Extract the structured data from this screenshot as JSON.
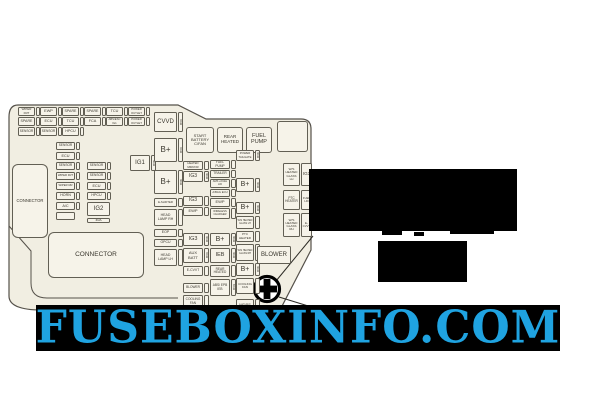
{
  "page": {
    "background": "#ffffff"
  },
  "watermark": {
    "text": "FUSEBOXINFO.COM",
    "text_color": "#1fa3e1",
    "band_color": "#000000",
    "band": {
      "x": 36,
      "y": 305,
      "w": 524,
      "h": 46
    }
  },
  "icons": {
    "marker": "plus-circle"
  },
  "diagram": {
    "panel_fill": "#f1eee2",
    "line_color": "#55514a",
    "box_fill": "#f6f3e9",
    "text_color": "#3a372e",
    "connectors": [
      {
        "x": 12,
        "y": 164,
        "w": 36,
        "h": 74,
        "label": "CONNECTOR",
        "fs": 4.2
      },
      {
        "x": 48,
        "y": 232,
        "w": 96,
        "h": 46,
        "label": "CONNECTOR",
        "fs": 6.5
      }
    ],
    "blocks": [
      {
        "x": 186,
        "y": 127,
        "w": 28,
        "h": 26,
        "label": "START\nBATTERY\nC/FAN",
        "fs": 4
      },
      {
        "x": 217,
        "y": 127,
        "w": 26,
        "h": 26,
        "label": "REAR\nHEATED",
        "fs": 4.5
      },
      {
        "x": 246,
        "y": 127,
        "w": 26,
        "h": 26,
        "label": "FUEL\nPUMP",
        "fs": 5.5
      },
      {
        "x": 277,
        "y": 121,
        "w": 31,
        "h": 31,
        "label": "",
        "fs": 4
      }
    ],
    "fuses": [
      {
        "x": 18,
        "y": 107,
        "w": 17,
        "h": 9,
        "label": "WIPER FRT",
        "fs": 3,
        "strip": "sq",
        "amp": ""
      },
      {
        "x": 40,
        "y": 107,
        "w": 17,
        "h": 9,
        "label": "EWP",
        "fs": 3.8,
        "strip": "sq",
        "amp": ""
      },
      {
        "x": 62,
        "y": 107,
        "w": 17,
        "h": 9,
        "label": "SPARE",
        "fs": 3.6,
        "strip": "sq",
        "amp": ""
      },
      {
        "x": 84,
        "y": 107,
        "w": 17,
        "h": 9,
        "label": "SPARE",
        "fs": 3.6,
        "strip": "sq",
        "amp": ""
      },
      {
        "x": 106,
        "y": 107,
        "w": 17,
        "h": 9,
        "label": "TCU",
        "fs": 3.8,
        "strip": "sq",
        "amp": ""
      },
      {
        "x": 128,
        "y": 107,
        "w": 17,
        "h": 9,
        "label": "POWER OUTLET",
        "fs": 2.8,
        "strip": "sq",
        "amp": ""
      },
      {
        "x": 18,
        "y": 117,
        "w": 17,
        "h": 9,
        "label": "SPARE",
        "fs": 3.6,
        "strip": "sq",
        "amp": ""
      },
      {
        "x": 40,
        "y": 117,
        "w": 17,
        "h": 9,
        "label": "ECU",
        "fs": 3.8,
        "strip": "sq",
        "amp": ""
      },
      {
        "x": 62,
        "y": 117,
        "w": 17,
        "h": 9,
        "label": "TCU",
        "fs": 3.8,
        "strip": "sq",
        "amp": ""
      },
      {
        "x": 84,
        "y": 117,
        "w": 17,
        "h": 9,
        "label": "FCA",
        "fs": 3.8,
        "strip": "sq",
        "amp": ""
      },
      {
        "x": 106,
        "y": 117,
        "w": 17,
        "h": 9,
        "label": "ABS/ESC IG1",
        "fs": 2.8,
        "strip": "sq",
        "amp": ""
      },
      {
        "x": 128,
        "y": 117,
        "w": 17,
        "h": 9,
        "label": "POWER OUTLET",
        "fs": 2.8,
        "strip": "sq",
        "amp": ""
      },
      {
        "x": 18,
        "y": 127,
        "w": 17,
        "h": 9,
        "label": "SENSOR",
        "fs": 3.2,
        "strip": "sq",
        "amp": ""
      },
      {
        "x": 40,
        "y": 127,
        "w": 17,
        "h": 9,
        "label": "SENSOR",
        "fs": 3.2,
        "strip": "sq",
        "amp": ""
      },
      {
        "x": 62,
        "y": 127,
        "w": 17,
        "h": 9,
        "label": "HPCU",
        "fs": 3.6,
        "strip": "sq",
        "amp": ""
      },
      {
        "x": 56,
        "y": 142,
        "w": 19,
        "h": 8,
        "label": "SENSOR",
        "fs": 3.2,
        "strip": "sq",
        "amp": ""
      },
      {
        "x": 56,
        "y": 152,
        "w": 19,
        "h": 8,
        "label": "ECU",
        "fs": 3.8,
        "strip": "sq",
        "amp": ""
      },
      {
        "x": 56,
        "y": 162,
        "w": 19,
        "h": 8,
        "label": "SENSOR",
        "fs": 3.2,
        "strip": "sq",
        "amp": ""
      },
      {
        "x": 56,
        "y": 172,
        "w": 19,
        "h": 8,
        "label": "WIPER FRT",
        "fs": 2.8,
        "strip": "sq",
        "amp": ""
      },
      {
        "x": 56,
        "y": 182,
        "w": 19,
        "h": 8,
        "label": "WIPER RR",
        "fs": 2.8,
        "strip": "sq",
        "amp": ""
      },
      {
        "x": 56,
        "y": 192,
        "w": 19,
        "h": 8,
        "label": "HORN",
        "fs": 3.6,
        "strip": "sq",
        "amp": ""
      },
      {
        "x": 56,
        "y": 202,
        "w": 19,
        "h": 8,
        "label": "A/C",
        "fs": 3.8,
        "strip": "sq",
        "amp": ""
      },
      {
        "x": 56,
        "y": 212,
        "w": 19,
        "h": 8,
        "label": "",
        "fs": 3.8,
        "strip": null,
        "amp": ""
      },
      {
        "x": 87,
        "y": 162,
        "w": 19,
        "h": 8,
        "label": "SENSOR",
        "fs": 3.2,
        "strip": "sq",
        "amp": ""
      },
      {
        "x": 87,
        "y": 172,
        "w": 19,
        "h": 8,
        "label": "SENSOR",
        "fs": 3.2,
        "strip": "sq",
        "amp": ""
      },
      {
        "x": 87,
        "y": 182,
        "w": 19,
        "h": 8,
        "label": "ECU",
        "fs": 3.8,
        "strip": "sq",
        "amp": ""
      },
      {
        "x": 87,
        "y": 192,
        "w": 19,
        "h": 8,
        "label": "HPCU",
        "fs": 3.6,
        "strip": "sq",
        "amp": ""
      },
      {
        "x": 87,
        "y": 202,
        "w": 23,
        "h": 14,
        "label": "IG2",
        "fs": 6,
        "strip": null,
        "amp": ""
      },
      {
        "x": 87,
        "y": 218,
        "w": 23,
        "h": 5,
        "label": "40A",
        "fs": 3.4,
        "strip": null,
        "amp": ""
      },
      {
        "x": 130,
        "y": 155,
        "w": 20,
        "h": 16,
        "label": "IG1",
        "fs": 6,
        "strip": "v",
        "amp": "40A"
      },
      {
        "x": 154,
        "y": 112,
        "w": 23,
        "h": 20,
        "label": "CVVD",
        "fs": 6,
        "strip": "v",
        "amp": "50A"
      },
      {
        "x": 154,
        "y": 138,
        "w": 23,
        "h": 24,
        "label": "B+",
        "fs": 8,
        "strip": "v",
        "amp": "50A"
      },
      {
        "x": 154,
        "y": 170,
        "w": 23,
        "h": 24,
        "label": "B+",
        "fs": 8,
        "strip": "v",
        "amp": "40A"
      },
      {
        "x": 154,
        "y": 198,
        "w": 23,
        "h": 9,
        "label": "E-SHIFTER",
        "fs": 2.8,
        "strip": "v",
        "amp": ""
      },
      {
        "x": 154,
        "y": 209,
        "w": 23,
        "h": 17,
        "label": "HEAD LAMP RH",
        "fs": 3.5,
        "strip": "v",
        "amp": ""
      },
      {
        "x": 154,
        "y": 229,
        "w": 23,
        "h": 8,
        "label": "EOP",
        "fs": 3.5,
        "strip": "v",
        "amp": ""
      },
      {
        "x": 154,
        "y": 239,
        "w": 23,
        "h": 8,
        "label": "OPCU",
        "fs": 3.5,
        "strip": "v",
        "amp": ""
      },
      {
        "x": 154,
        "y": 249,
        "w": 23,
        "h": 17,
        "label": "HEAD LAMP LH",
        "fs": 3.5,
        "strip": "v",
        "amp": ""
      },
      {
        "x": 183,
        "y": 161,
        "w": 20,
        "h": 9,
        "label": "HEATED MIRROR",
        "fs": 2.8,
        "strip": "v",
        "amp": ""
      },
      {
        "x": 183,
        "y": 171,
        "w": 20,
        "h": 11,
        "label": "IG3",
        "fs": 5,
        "strip": "v",
        "amp": "40A"
      },
      {
        "x": 183,
        "y": 196,
        "w": 20,
        "h": 10,
        "label": "IG3",
        "fs": 5,
        "strip": "v",
        "amp": ""
      },
      {
        "x": 183,
        "y": 207,
        "w": 20,
        "h": 9,
        "label": "EWP",
        "fs": 4,
        "strip": "v",
        "amp": ""
      },
      {
        "x": 183,
        "y": 233,
        "w": 20,
        "h": 13,
        "label": "IG3",
        "fs": 5.5,
        "strip": "v",
        "amp": "40A"
      },
      {
        "x": 183,
        "y": 248,
        "w": 20,
        "h": 15,
        "label": "AUX BATT",
        "fs": 4,
        "strip": "v",
        "amp": "50A"
      },
      {
        "x": 183,
        "y": 266,
        "w": 20,
        "h": 10,
        "label": "E-CVVT",
        "fs": 3.4,
        "strip": "v",
        "amp": ""
      },
      {
        "x": 183,
        "y": 283,
        "w": 20,
        "h": 10,
        "label": "BLOWER",
        "fs": 3.2,
        "strip": "v",
        "amp": ""
      },
      {
        "x": 183,
        "y": 295,
        "w": 20,
        "h": 13,
        "label": "COOLING FAN",
        "fs": 3.2,
        "strip": "v",
        "amp": ""
      },
      {
        "x": 210,
        "y": 160,
        "w": 20,
        "h": 9,
        "label": "FUEL PUMP",
        "fs": 3.2,
        "strip": "v",
        "amp": ""
      },
      {
        "x": 210,
        "y": 170,
        "w": 20,
        "h": 8,
        "label": "TRAILER",
        "fs": 3.2,
        "strip": "v",
        "amp": ""
      },
      {
        "x": 210,
        "y": 179,
        "w": 20,
        "h": 9,
        "label": "AMS +FUEL LID",
        "fs": 2.6,
        "strip": "v",
        "amp": ""
      },
      {
        "x": 210,
        "y": 189,
        "w": 20,
        "h": 8,
        "label": "A/BAG ECU",
        "fs": 2.8,
        "strip": "v",
        "amp": ""
      },
      {
        "x": 210,
        "y": 198,
        "w": 20,
        "h": 9,
        "label": "EWP",
        "fs": 4,
        "strip": "v",
        "amp": ""
      },
      {
        "x": 210,
        "y": 208,
        "w": 20,
        "h": 11,
        "label": "WIRELESS CHARGER",
        "fs": 2.6,
        "strip": "v",
        "amp": ""
      },
      {
        "x": 210,
        "y": 233,
        "w": 20,
        "h": 13,
        "label": "B+",
        "fs": 7,
        "strip": "v",
        "amp": "40A"
      },
      {
        "x": 210,
        "y": 248,
        "w": 20,
        "h": 15,
        "label": "IEB",
        "fs": 5.5,
        "strip": "v",
        "amp": "40A"
      },
      {
        "x": 210,
        "y": 265,
        "w": 20,
        "h": 12,
        "label": "REAR HEATED",
        "fs": 3.2,
        "strip": "v",
        "amp": ""
      },
      {
        "x": 210,
        "y": 279,
        "w": 20,
        "h": 17,
        "label": "ABS/ EPB IEB",
        "fs": 3.2,
        "strip": "v",
        "amp": "60A"
      },
      {
        "x": 236,
        "y": 150,
        "w": 18,
        "h": 11,
        "label": "POWER TAILGATE",
        "fs": 2.8,
        "strip": "v",
        "amp": "40A"
      },
      {
        "x": 236,
        "y": 178,
        "w": 18,
        "h": 14,
        "label": "B+",
        "fs": 7,
        "strip": "v",
        "amp": "40A"
      },
      {
        "x": 236,
        "y": 202,
        "w": 18,
        "h": 12,
        "label": "B+",
        "fs": 7,
        "strip": "v",
        "amp": "40A"
      },
      {
        "x": 236,
        "y": 216,
        "w": 18,
        "h": 13,
        "label": "W/S HEATED GLASS LH",
        "fs": 2.4,
        "strip": "v",
        "amp": ""
      },
      {
        "x": 236,
        "y": 231,
        "w": 18,
        "h": 11,
        "label": "PTC HEATER",
        "fs": 3,
        "strip": "v",
        "amp": ""
      },
      {
        "x": 236,
        "y": 244,
        "w": 18,
        "h": 17,
        "label": "W/S HEATED GLASS RH",
        "fs": 2.4,
        "strip": "v",
        "amp": ""
      },
      {
        "x": 236,
        "y": 263,
        "w": 18,
        "h": 13,
        "label": "B+",
        "fs": 7,
        "strip": "v",
        "amp": "40A"
      },
      {
        "x": 236,
        "y": 278,
        "w": 18,
        "h": 16,
        "label": "COOLING FAN",
        "fs": 3,
        "strip": "v",
        "amp": ""
      },
      {
        "x": 236,
        "y": 299,
        "w": 18,
        "h": 12,
        "label": "MDPS",
        "fs": 4,
        "strip": "v",
        "amp": ""
      },
      {
        "x": 283,
        "y": 163,
        "w": 17,
        "h": 23,
        "label": "W/S HEATED GLASS LH",
        "fs": 3,
        "strip": null,
        "amp": ""
      },
      {
        "x": 301,
        "y": 163,
        "w": 11,
        "h": 23,
        "label": "IG3",
        "fs": 4.5,
        "strip": null,
        "amp": ""
      },
      {
        "x": 283,
        "y": 190,
        "w": 17,
        "h": 20,
        "label": "PTC HEATER",
        "fs": 3.2,
        "strip": null,
        "amp": ""
      },
      {
        "x": 301,
        "y": 190,
        "w": 11,
        "h": 20,
        "label": "FUEL LID",
        "fs": 2.8,
        "strip": null,
        "amp": ""
      },
      {
        "x": 283,
        "y": 213,
        "w": 17,
        "h": 24,
        "label": "W/S HEATED GLASS RH",
        "fs": 3,
        "strip": null,
        "amp": ""
      },
      {
        "x": 301,
        "y": 213,
        "w": 11,
        "h": 24,
        "label": "E-CVVT",
        "fs": 2.9,
        "strip": null,
        "amp": ""
      },
      {
        "x": 257,
        "y": 246,
        "w": 34,
        "h": 18,
        "label": "BLOWER",
        "fs": 6,
        "strip": null,
        "amp": ""
      }
    ],
    "redactions": [
      {
        "x": 309,
        "y": 169,
        "w": 208,
        "h": 62
      },
      {
        "x": 378,
        "y": 241,
        "w": 89,
        "h": 41
      },
      {
        "x": 382,
        "y": 229,
        "w": 20,
        "h": 6
      },
      {
        "x": 414,
        "y": 232,
        "w": 10,
        "h": 4
      },
      {
        "x": 450,
        "y": 226,
        "w": 44,
        "h": 8
      }
    ]
  }
}
